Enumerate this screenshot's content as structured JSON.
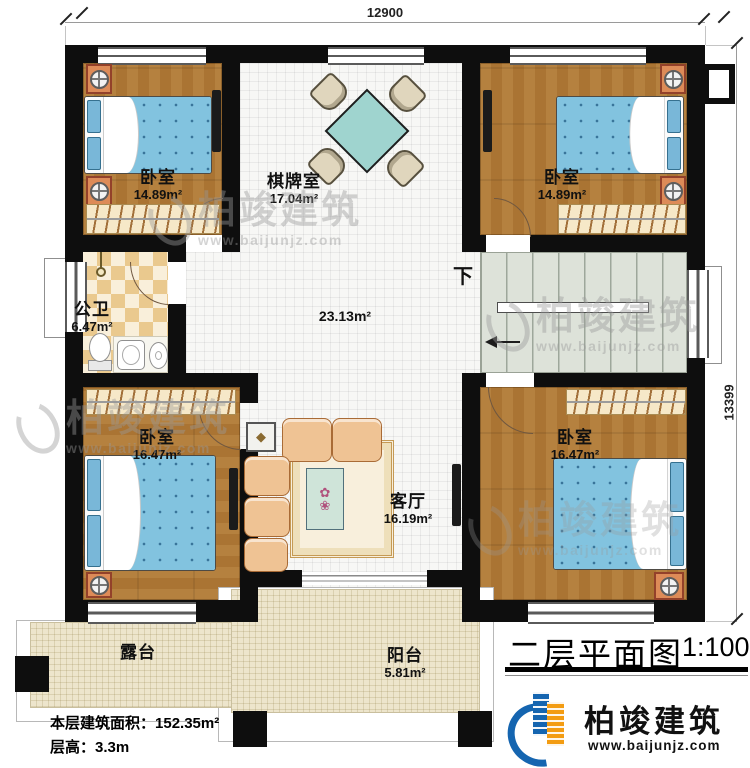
{
  "meta": {
    "title": "二层平面图",
    "scale": "1:100",
    "area_label": "本层建筑面积：",
    "area_value": "152.35m²",
    "height_label": "层高：",
    "height_value": "3.3m"
  },
  "dimensions": {
    "top": "12900",
    "right": "13399"
  },
  "rooms": [
    {
      "id": "bedroom-tl",
      "name": "卧室",
      "area": "14.89m²"
    },
    {
      "id": "game-room",
      "name": "棋牌室",
      "area": "17.04m²"
    },
    {
      "id": "bedroom-tr",
      "name": "卧室",
      "area": "14.89m²"
    },
    {
      "id": "bathroom",
      "name": "公卫",
      "area": "6.47m²"
    },
    {
      "id": "hall",
      "name": "",
      "area": "23.13m²"
    },
    {
      "id": "bedroom-bl",
      "name": "卧室",
      "area": "16.47m²"
    },
    {
      "id": "living-room",
      "name": "客厅",
      "area": "16.19m²"
    },
    {
      "id": "bedroom-br",
      "name": "卧室",
      "area": "16.47m²"
    },
    {
      "id": "terrace",
      "name": "露台",
      "area": ""
    },
    {
      "id": "balcony",
      "name": "阳台",
      "area": "5.81m²"
    }
  ],
  "stairs": {
    "down_label": "下"
  },
  "branding": {
    "company": "柏竣建筑",
    "website": "www.baijunjz.com"
  },
  "watermark": {
    "text": "柏竣建筑",
    "url": "www.baijunjz.com"
  },
  "colors": {
    "wall": "#0e0e0e",
    "wood": "#b5813f",
    "tile_grid": "#f7f7f5",
    "stairs": "#dde2d9",
    "patio": "#ede5cc",
    "checker_tan": "#eac98e",
    "bed_blue": "#82c3df",
    "table_teal": "#9fd4cf",
    "logo_blue": "#1565b0",
    "logo_orange": "#f39c12"
  }
}
